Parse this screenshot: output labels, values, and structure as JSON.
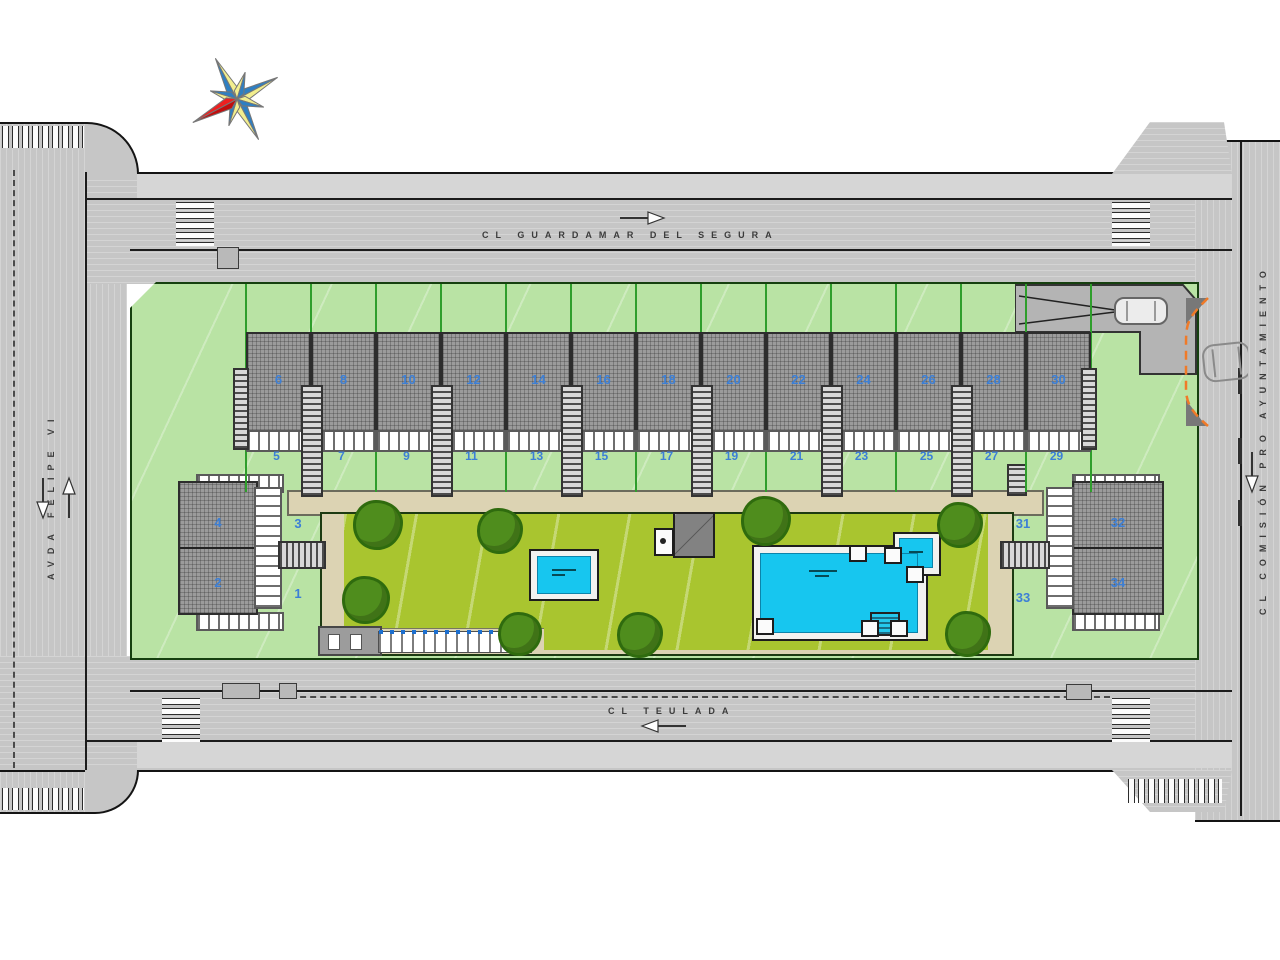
{
  "plan": {
    "streets": {
      "top": "CL GUARDAMAR DEL SEGURA",
      "bottom": "CL TEULADA",
      "left": "AVDA FELIPE VI",
      "right": "CL COMISIÓN PRO AYUNTAMIENTO"
    },
    "row_houses": {
      "upper": [
        "6",
        "8",
        "10",
        "12",
        "14",
        "16",
        "18",
        "20",
        "22",
        "24",
        "26",
        "28",
        "30"
      ],
      "lower": [
        "5",
        "7",
        "9",
        "11",
        "13",
        "15",
        "17",
        "19",
        "21",
        "23",
        "25",
        "27",
        "29"
      ]
    },
    "west_building": {
      "upper_roof": "4",
      "lower_roof": "2",
      "upper_plot": "3",
      "lower_plot": "1"
    },
    "east_building": {
      "upper_roof": "32",
      "lower_roof": "34",
      "upper_plot": "31",
      "lower_plot": "33"
    },
    "icons": {
      "compass": "compass-rose-8-point-star",
      "cars": "car-top-view",
      "arrows": "traffic-direction-arrows"
    },
    "colors": {
      "plot_green": "#b9e3a4",
      "lawn_green": "#a9c52f",
      "pool_cyan": "#17c6ef",
      "unit_number_blue": "#3c7fd6",
      "path_tan": "#dcd3b3",
      "road_gray": "#c6c6c6",
      "turn_radius_orange": "#f07a28"
    }
  }
}
